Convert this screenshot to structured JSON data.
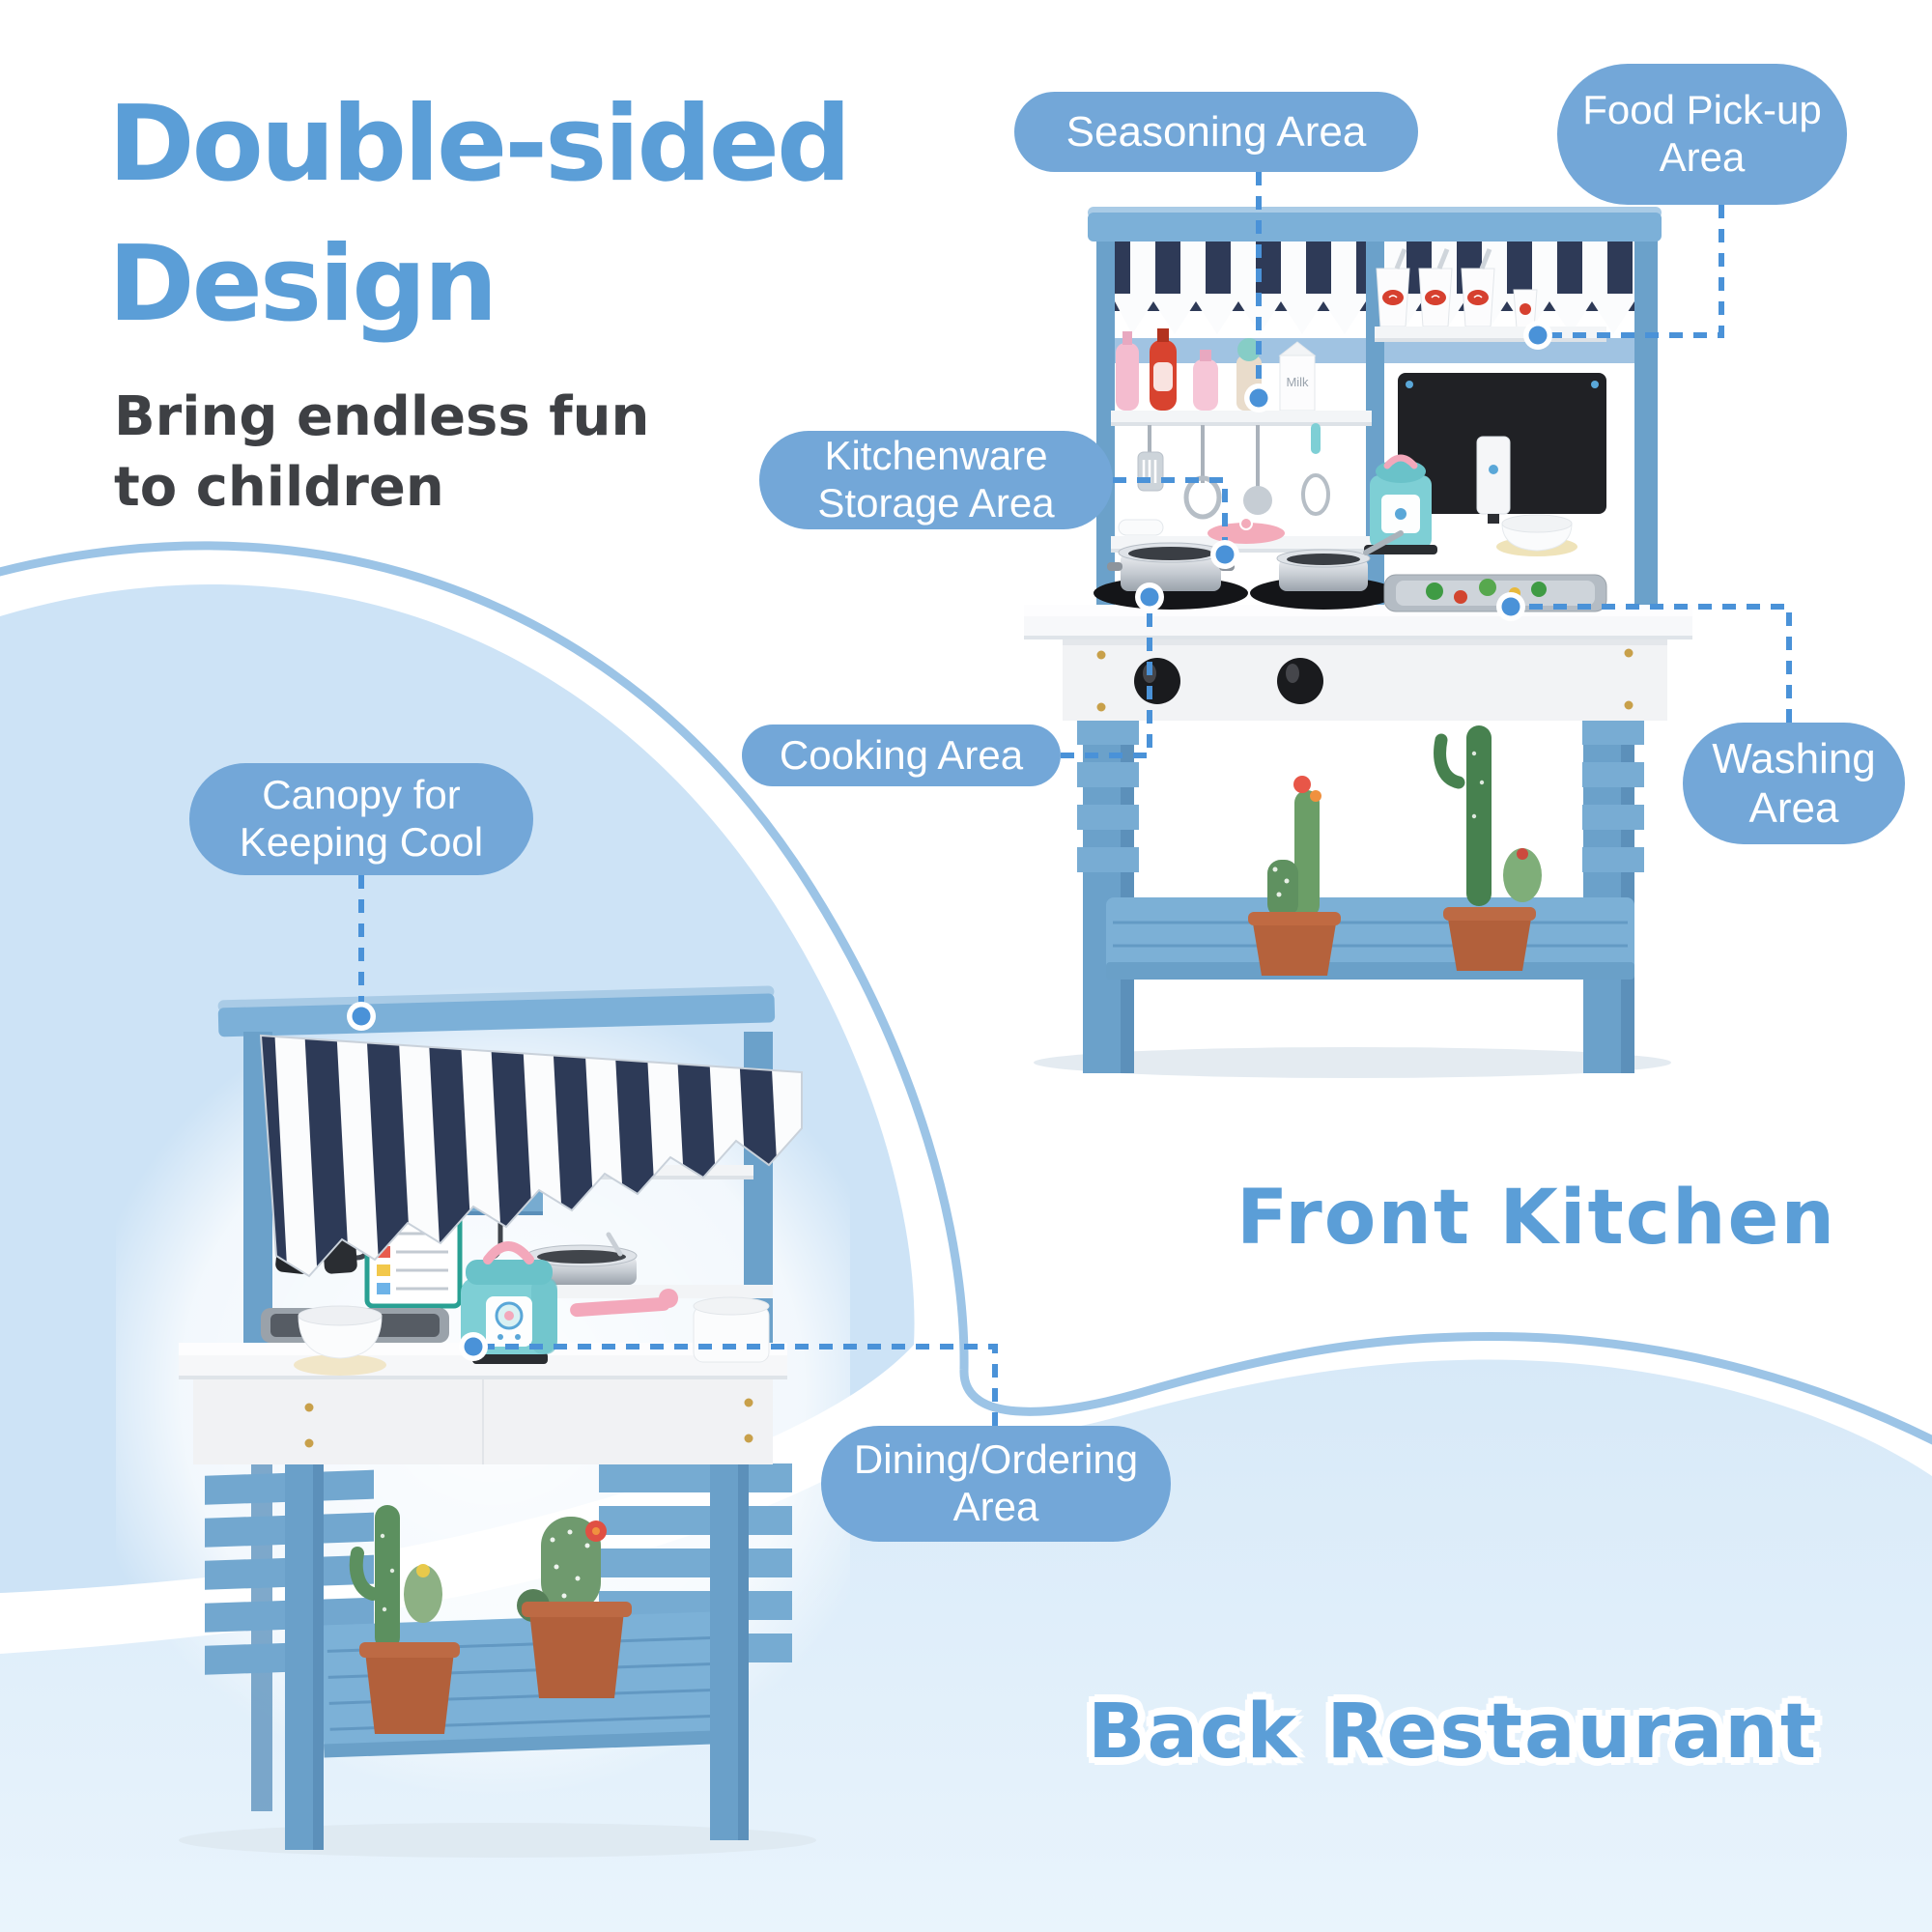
{
  "header": {
    "title_line1": "Double-sided",
    "title_line2": "Design",
    "subtitle_line1": "Bring endless fun",
    "subtitle_line2": "to children"
  },
  "views": {
    "front": {
      "label": "Front Kitchen"
    },
    "back": {
      "label": "Back Restaurant"
    }
  },
  "callouts": {
    "seasoning": {
      "label": "Seasoning Area"
    },
    "food_pickup": {
      "line1": "Food Pick-up",
      "line2": "Area"
    },
    "kitchenware": {
      "line1": "Kitchenware",
      "line2": "Storage Area"
    },
    "cooking": {
      "label": "Cooking Area"
    },
    "washing": {
      "line1": "Washing",
      "line2": "Area"
    },
    "canopy": {
      "line1": "Canopy for",
      "line2": "Keeping Cool"
    },
    "dining": {
      "line1": "Dining/Ordering",
      "line2": "Area"
    }
  },
  "products": {
    "milk_label": "Milk"
  },
  "colors": {
    "bubble_text": "#5b9ed7",
    "pill_bg": "#73a7d8",
    "pill_text": "#ffffff",
    "dash": "#4a92d8",
    "wave_fill_left": "#cde3f6",
    "wave_fill_bottom": "#dcecf9",
    "wave_stroke": "#9cc4e6",
    "wood_blue": "#6ba1ca",
    "canopy_navy": "#2d3a57",
    "subtitle_text": "#3e4044"
  }
}
